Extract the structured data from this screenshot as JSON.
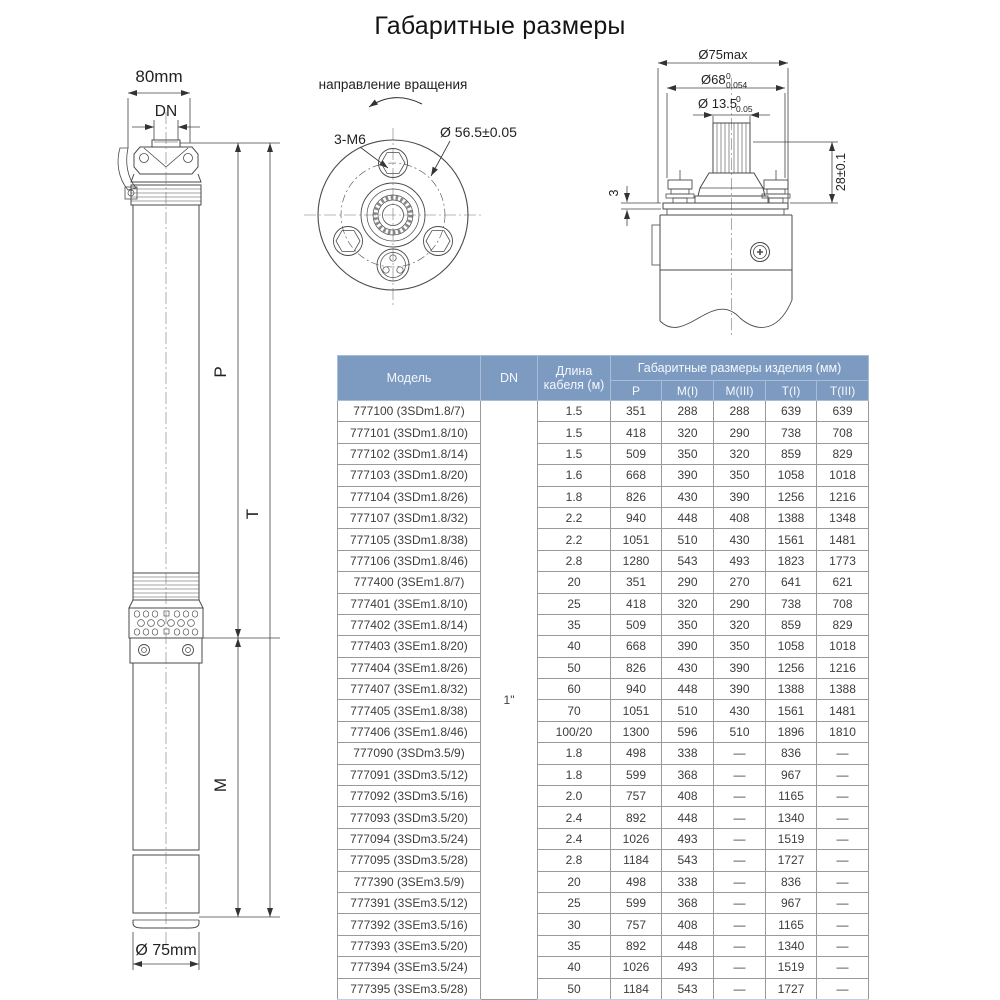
{
  "title": "Габаритные размеры",
  "drawing_side": {
    "width_label": "80mm",
    "dn_label": "DN",
    "p_label": "P",
    "t_label": "T",
    "m_label": "M",
    "bottom_diameter_label": "Ø 75mm"
  },
  "drawing_flange": {
    "rotation_label": "направление вращения",
    "bolts_label": "3-M6",
    "circle_label": "Ø 56.5±0.05"
  },
  "drawing_head": {
    "d75_label": "Ø75max",
    "d68_label": "Ø68",
    "d68_sup": "0",
    "d68_sub": "0.054",
    "d135_label": "Ø 13.5",
    "d135_sup": "0",
    "d135_sub": "0.05",
    "height_label": "28±0.1",
    "plate_label": "3"
  },
  "table": {
    "headers": {
      "model": "Модель",
      "dn": "DN",
      "cable": "Длина кабеля (м)",
      "dims_group": "Габаритные размеры изделия (мм)",
      "dims": [
        "P",
        "M(I)",
        "M(III)",
        "T(I)",
        "T(III)"
      ]
    },
    "dn_value": "1\"",
    "rows": [
      {
        "model": "777100 (3SDm1.8/7)",
        "cable": "1.5",
        "p": "351",
        "m1": "288",
        "m3": "288",
        "t1": "639",
        "t3": "639"
      },
      {
        "model": "777101 (3SDm1.8/10)",
        "cable": "1.5",
        "p": "418",
        "m1": "320",
        "m3": "290",
        "t1": "738",
        "t3": "708"
      },
      {
        "model": "777102 (3SDm1.8/14)",
        "cable": "1.5",
        "p": "509",
        "m1": "350",
        "m3": "320",
        "t1": "859",
        "t3": "829"
      },
      {
        "model": "777103 (3SDm1.8/20)",
        "cable": "1.6",
        "p": "668",
        "m1": "390",
        "m3": "350",
        "t1": "1058",
        "t3": "1018"
      },
      {
        "model": "777104 (3SDm1.8/26)",
        "cable": "1.8",
        "p": "826",
        "m1": "430",
        "m3": "390",
        "t1": "1256",
        "t3": "1216"
      },
      {
        "model": "777107 (3SDm1.8/32)",
        "cable": "2.2",
        "p": "940",
        "m1": "448",
        "m3": "408",
        "t1": "1388",
        "t3": "1348"
      },
      {
        "model": "777105 (3SDm1.8/38)",
        "cable": "2.2",
        "p": "1051",
        "m1": "510",
        "m3": "430",
        "t1": "1561",
        "t3": "1481"
      },
      {
        "model": "777106 (3SDm1.8/46)",
        "cable": "2.8",
        "p": "1280",
        "m1": "543",
        "m3": "493",
        "t1": "1823",
        "t3": "1773"
      },
      {
        "model": "777400 (3SEm1.8/7)",
        "cable": "20",
        "p": "351",
        "m1": "290",
        "m3": "270",
        "t1": "641",
        "t3": "621"
      },
      {
        "model": "777401 (3SEm1.8/10)",
        "cable": "25",
        "p": "418",
        "m1": "320",
        "m3": "290",
        "t1": "738",
        "t3": "708"
      },
      {
        "model": "777402 (3SEm1.8/14)",
        "cable": "35",
        "p": "509",
        "m1": "350",
        "m3": "320",
        "t1": "859",
        "t3": "829"
      },
      {
        "model": "777403 (3SEm1.8/20)",
        "cable": "40",
        "p": "668",
        "m1": "390",
        "m3": "350",
        "t1": "1058",
        "t3": "1018"
      },
      {
        "model": "777404 (3SEm1.8/26)",
        "cable": "50",
        "p": "826",
        "m1": "430",
        "m3": "390",
        "t1": "1256",
        "t3": "1216"
      },
      {
        "model": "777407 (3SEm1.8/32)",
        "cable": "60",
        "p": "940",
        "m1": "448",
        "m3": "390",
        "t1": "1388",
        "t3": "1388"
      },
      {
        "model": "777405 (3SEm1.8/38)",
        "cable": "70",
        "p": "1051",
        "m1": "510",
        "m3": "430",
        "t1": "1561",
        "t3": "1481"
      },
      {
        "model": "777406 (3SEm1.8/46)",
        "cable": "100/20",
        "p": "1300",
        "m1": "596",
        "m3": "510",
        "t1": "1896",
        "t3": "1810"
      },
      {
        "model": "777090 (3SDm3.5/9)",
        "cable": "1.8",
        "p": "498",
        "m1": "338",
        "m3": "—",
        "t1": "836",
        "t3": "—"
      },
      {
        "model": "777091 (3SDm3.5/12)",
        "cable": "1.8",
        "p": "599",
        "m1": "368",
        "m3": "—",
        "t1": "967",
        "t3": "—"
      },
      {
        "model": "777092 (3SDm3.5/16)",
        "cable": "2.0",
        "p": "757",
        "m1": "408",
        "m3": "—",
        "t1": "1165",
        "t3": "—"
      },
      {
        "model": "777093 (3SDm3.5/20)",
        "cable": "2.4",
        "p": "892",
        "m1": "448",
        "m3": "—",
        "t1": "1340",
        "t3": "—"
      },
      {
        "model": "777094 (3SDm3.5/24)",
        "cable": "2.4",
        "p": "1026",
        "m1": "493",
        "m3": "—",
        "t1": "1519",
        "t3": "—"
      },
      {
        "model": "777095 (3SDm3.5/28)",
        "cable": "2.8",
        "p": "1184",
        "m1": "543",
        "m3": "—",
        "t1": "1727",
        "t3": "—"
      },
      {
        "model": "777390 (3SEm3.5/9)",
        "cable": "20",
        "p": "498",
        "m1": "338",
        "m3": "—",
        "t1": "836",
        "t3": "—"
      },
      {
        "model": "777391 (3SEm3.5/12)",
        "cable": "25",
        "p": "599",
        "m1": "368",
        "m3": "—",
        "t1": "967",
        "t3": "—"
      },
      {
        "model": "777392 (3SEm3.5/16)",
        "cable": "30",
        "p": "757",
        "m1": "408",
        "m3": "—",
        "t1": "1165",
        "t3": "—"
      },
      {
        "model": "777393 (3SEm3.5/20)",
        "cable": "35",
        "p": "892",
        "m1": "448",
        "m3": "—",
        "t1": "1340",
        "t3": "—"
      },
      {
        "model": "777394 (3SEm3.5/24)",
        "cable": "40",
        "p": "1026",
        "m1": "493",
        "m3": "—",
        "t1": "1519",
        "t3": "—"
      },
      {
        "model": "777395 (3SEm3.5/28)",
        "cable": "50",
        "p": "1184",
        "m1": "543",
        "m3": "—",
        "t1": "1727",
        "t3": "—"
      }
    ]
  }
}
